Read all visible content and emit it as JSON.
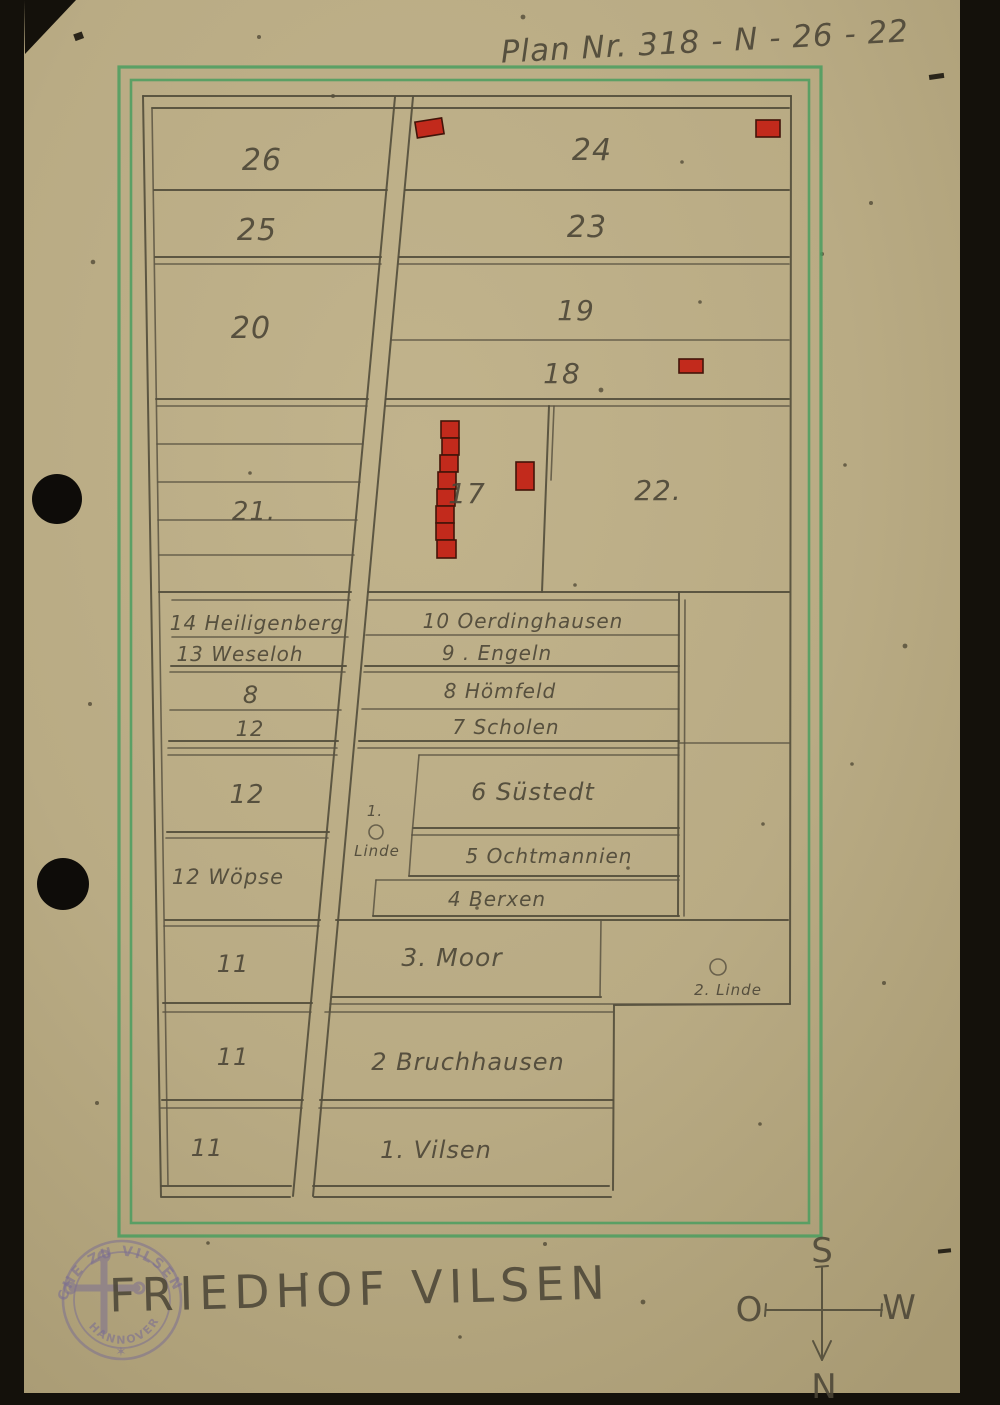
{
  "header": {
    "plan_number": "Plan Nr. 318 - N - 26 - 22"
  },
  "footer": {
    "title": "FRIEDHOF VILSEN"
  },
  "sections": {
    "s26": "26",
    "s25": "25",
    "s20": "20",
    "s21": "21.",
    "s24": "24",
    "s23": "23",
    "s19": "19",
    "s18": "18",
    "s17": "17",
    "s22": "22.",
    "s14": "14 Heiligenberg",
    "s13": "13 Weseloh",
    "s10": "10 Oerdinghausen",
    "s9": "9 . Engeln",
    "s8_left": "8",
    "s8_right": "8 Hömfeld",
    "s12_a": "12",
    "s7": "7 Scholen",
    "s12_b": "12",
    "s6": "6 Süstedt",
    "s5": "5 Ochtmannien",
    "s12_wopse": "12 Wöpse",
    "s4": "4 Berxen",
    "s11_a": "11",
    "s3": "3. Moor",
    "s11_b": "11",
    "s2": "2 Bruchhausen",
    "s11_c": "11",
    "s1": "1. Vilsen"
  },
  "trees": {
    "linde1_no": "1.",
    "linde1_name": "Linde",
    "linde2_name": "2. Linde",
    "symbol": "circle-tree-symbol"
  },
  "compass": {
    "top": "S",
    "bottom": "N",
    "left": "O",
    "right": "W"
  },
  "stamp": {
    "ring_text": "CHE ZU VILSEN",
    "inner_text": "HANNOVER",
    "star": "✶",
    "symbol": "budded-cross"
  },
  "red_markers": [
    "flag at top of main path (section 24 west edge)",
    "mark at north-east corner of section 24",
    "mark in section 18",
    "column of eight marks in section 17",
    "single upright mark east of column in section 17"
  ],
  "colors": {
    "paper": "#b9ac85",
    "pencil": "#544e3c",
    "green_border": "#4a9e5f",
    "red_marker": "#c22a1c",
    "stamp_purple": "#7c6f92",
    "scan_background": "#14110b"
  }
}
